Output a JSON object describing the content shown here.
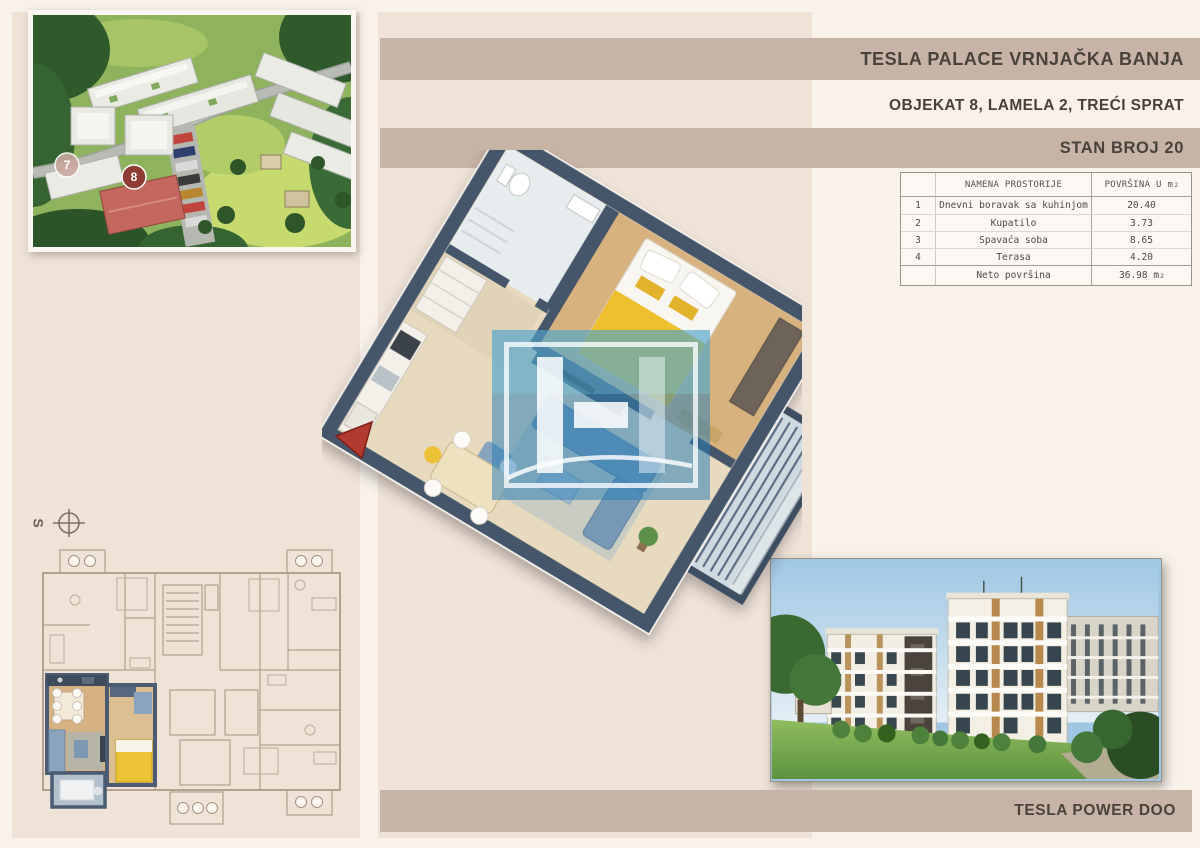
{
  "header": {
    "project": "TESLA PALACE VRNJAČKA BANJA",
    "location_line": "OBJEKAT 8, LAMELA 2, TREĆI SPRAT",
    "unit": "STAN BROJ 20"
  },
  "footer": {
    "company": "TESLA POWER DOO"
  },
  "area_table": {
    "col_name_header": "NAMENA PROSTORIJE",
    "col_area_header": "POVRŠINA U m",
    "col_area_sup": "2",
    "rows": [
      {
        "num": "1",
        "name": "Dnevni boravak sa kuhinjom",
        "area": "20.40"
      },
      {
        "num": "2",
        "name": "Kupatilo",
        "area": "3.73"
      },
      {
        "num": "3",
        "name": "Spavaća soba",
        "area": "8.65"
      },
      {
        "num": "4",
        "name": "Terasa",
        "area": "4.20"
      }
    ],
    "total_label": "Neto površina",
    "total_value": "36.98",
    "total_unit": "m",
    "total_sup": "2"
  },
  "site_plan": {
    "badge_building_7": "7",
    "badge_building_8": "8"
  },
  "compass": {
    "label": "S"
  },
  "colors": {
    "bar": "#c7b4a6",
    "bar_text": "#49423b",
    "background": "#efe3d8",
    "background_light": "#f8f2eb",
    "watermark_blue": "#2b82b9",
    "bed_yellow": "#eec02e",
    "wall_blue": "#44556b"
  }
}
